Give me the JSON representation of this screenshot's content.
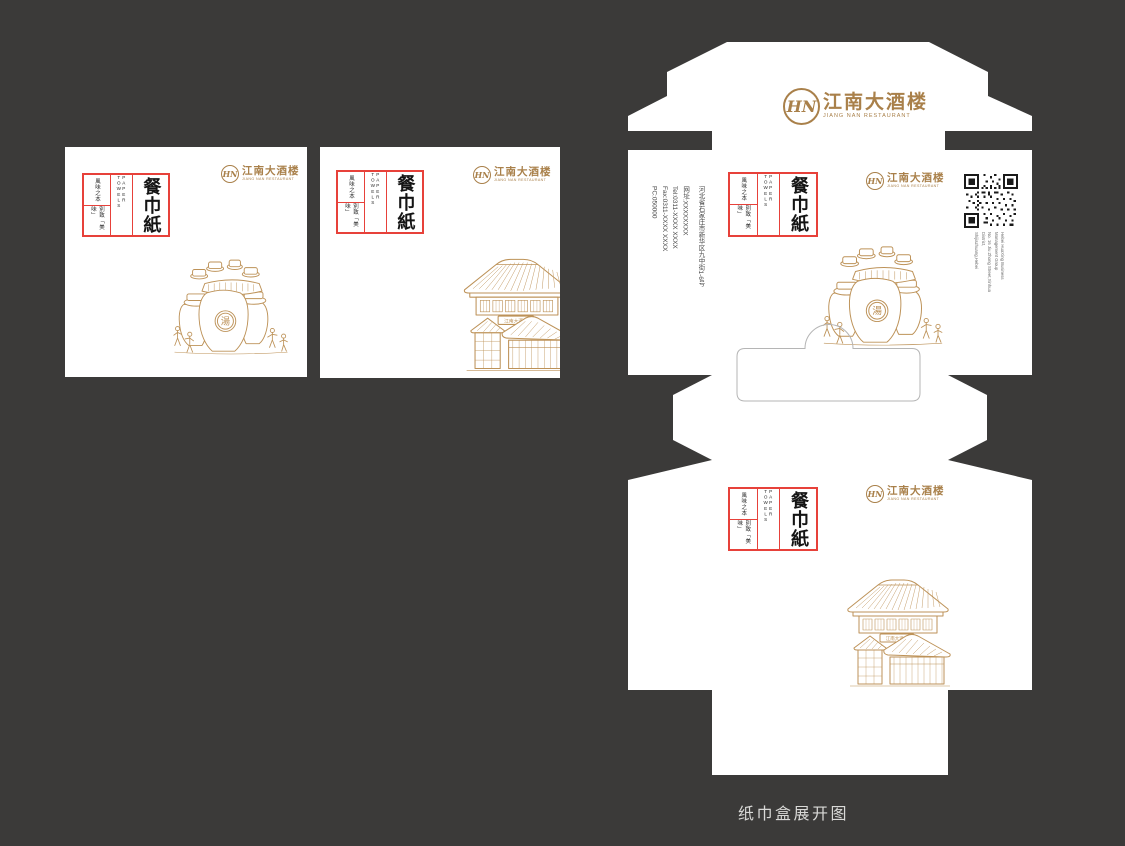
{
  "page": {
    "caption": "纸巾盒展开图",
    "background_color": "#3b3a39",
    "panel_color": "#ffffff"
  },
  "brand": {
    "logo_initials": "HN",
    "name_cn": "江南大酒楼",
    "name_en": "JIANG NAN RESTAURANT",
    "gold_color": "#a9804a"
  },
  "label": {
    "title": "餐巾紙",
    "subtitle_en": "PAPER TOWELS",
    "tagline_top": "風味之本",
    "tagline_bottom": "別致「美味」",
    "border_color": "#e7413a"
  },
  "contact": {
    "address": "河北省石家庄市新华区九中街1-6号",
    "website": "网址:XXXXXXXX",
    "tel": "Tel:0311-XXXX XXXX",
    "fax": "Fax:0311-XXXX XXXX",
    "postcode": "PC:050000"
  },
  "qr_caption": [
    "Hebei HuaXing Business",
    "Management Group",
    "No. 16 Jiu Zhong Street,Xinhua District,",
    "Shijiazhuang,Hebei"
  ],
  "illustrations": {
    "soup_seal": "湯",
    "house_sign": "江南大酒楼",
    "line_color": "#bd9258"
  }
}
